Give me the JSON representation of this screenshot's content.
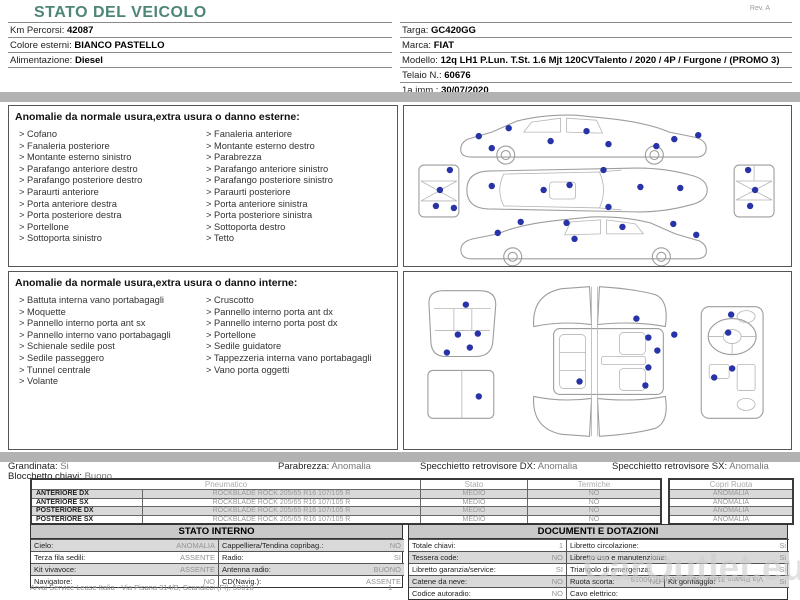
{
  "page": {
    "title": "STATO DEL VEICOLO",
    "rev": "Rev. A"
  },
  "colors": {
    "title": "#4d8577",
    "marker": "#2733a6"
  },
  "vehicle_info": {
    "left": [
      {
        "label": "Km Percorsi:",
        "value": "42087"
      },
      {
        "label": "Colore esterni:",
        "value": "BIANCO PASTELLO"
      },
      {
        "label": "Alimentazione:",
        "value": "Diesel"
      }
    ],
    "right": [
      {
        "label": "Targa:",
        "value": "GC420GG"
      },
      {
        "label": "Marca:",
        "value": "FIAT"
      },
      {
        "label": "Modello:",
        "value": "12q LH1 P.Lun. T.St. 1.6 Mjt 120CVTalento / 2020 / 4P / Furgone / (PROMO 3)"
      },
      {
        "label": "Telaio N.:",
        "value": "60676"
      },
      {
        "label": "1a imm.:",
        "value": "30/07/2020"
      }
    ]
  },
  "exterior_section": {
    "header": "Anomalie da normale usura,extra usura o danno esterne:",
    "col1": [
      "Cofano",
      "Fanaleria posteriore",
      "Montante esterno sinistro",
      "Parafango anteriore destro",
      "Parafango posteriore destro",
      "Paraurti anteriore",
      "Porta anteriore destra",
      "Porta posteriore destra",
      "Portellone",
      "Sottoporta sinistro"
    ],
    "col2": [
      "Fanaleria anteriore",
      "Montante esterno destro",
      "Parabrezza",
      "Parafango anteriore sinistro",
      "Parafango posteriore sinistro",
      "Paraurti posteriore",
      "Porta anteriore sinistra",
      "Porta posteriore sinistra",
      "Sottoporta destro",
      "Tetto"
    ],
    "markers": [
      [
        75,
        30
      ],
      [
        88,
        42
      ],
      [
        105,
        22
      ],
      [
        147,
        35
      ],
      [
        183,
        25
      ],
      [
        205,
        38
      ],
      [
        253,
        40
      ],
      [
        271,
        33
      ],
      [
        295,
        29
      ],
      [
        88,
        80
      ],
      [
        140,
        84
      ],
      [
        166,
        79
      ],
      [
        200,
        64
      ],
      [
        237,
        81
      ],
      [
        277,
        82
      ],
      [
        205,
        101
      ],
      [
        46,
        64
      ],
      [
        36,
        84
      ],
      [
        32,
        100
      ],
      [
        50,
        102
      ],
      [
        345,
        64
      ],
      [
        352,
        84
      ],
      [
        347,
        100
      ],
      [
        94,
        127
      ],
      [
        117,
        116
      ],
      [
        163,
        117
      ],
      [
        171,
        133
      ],
      [
        219,
        121
      ],
      [
        270,
        118
      ],
      [
        293,
        129
      ]
    ]
  },
  "interior_section": {
    "header": "Anomalie da normale usura,extra usura o danno interne:",
    "col1": [
      "Battuta interna vano portabagagli",
      "Moquette",
      "Pannello interno porta ant sx",
      "Pannello interno vano portabagagli",
      "Schienale sedile post",
      "Sedile passeggero",
      "Tunnel centrale",
      "Volante"
    ],
    "col2": [
      "Cruscotto",
      "Pannello interno porta ant dx",
      "Pannello interno porta post dx",
      "Portellone",
      "Sedile guidatore",
      "Tappezzeria interna vano portabagagli",
      "Vano porta oggetti"
    ],
    "markers": [
      [
        62,
        24
      ],
      [
        54,
        54
      ],
      [
        74,
        53
      ],
      [
        66,
        67
      ],
      [
        43,
        72
      ],
      [
        75,
        116
      ],
      [
        233,
        38
      ],
      [
        245,
        57
      ],
      [
        271,
        54
      ],
      [
        254,
        70
      ],
      [
        245,
        87
      ],
      [
        176,
        101
      ],
      [
        242,
        105
      ],
      [
        328,
        34
      ],
      [
        325,
        52
      ],
      [
        329,
        88
      ],
      [
        311,
        97
      ]
    ]
  },
  "condition": {
    "grandinata": {
      "label": "Grandinata:",
      "value": "Si"
    },
    "blocchetto": {
      "label": "Blocchetto chiavi:",
      "value": "Buono"
    },
    "parabrezza": {
      "label": "Parabrezza:",
      "value": "Anomalia"
    },
    "specchietto_dx": {
      "label": "Specchietto retrovisore DX:",
      "value": "Anomalia"
    },
    "specchietto_sx": {
      "label": "Specchietto retrovisore SX:",
      "value": "Anomalia"
    }
  },
  "tyre_table": {
    "header_pneumatico": "Pneumatico",
    "header_stato": "Stato",
    "header_termiche": "Termiche",
    "header_copri": "Copri Ruota",
    "rows": [
      {
        "position": "ANTERIORE DX",
        "tyre": "ROCKBLADE ROCK 205/65 R16 107/105 R",
        "stato": "MEDIO",
        "termiche": "NO",
        "copri": "ANOMALIA"
      },
      {
        "position": "ANTERIORE SX",
        "tyre": "ROCKBLADE ROCK 205/65 R16 107/105 R",
        "stato": "MEDIO",
        "termiche": "NO",
        "copri": "ANOMALIA"
      },
      {
        "position": "POSTERIORE DX",
        "tyre": "ROCKBLADE ROCK 205/65 R16 107/105 R",
        "stato": "MEDIO",
        "termiche": "NO",
        "copri": "ANOMALIA"
      },
      {
        "position": "POSTERIORE SX",
        "tyre": "ROCKBLADE ROCK 205/65 R16 107/105 R",
        "stato": "MEDIO",
        "termiche": "NO",
        "copri": "ANOMALIA"
      }
    ]
  },
  "stato_interno": {
    "title": "STATO INTERNO",
    "rows": [
      {
        "l1": "Cielo:",
        "v1": "ANOMALIA",
        "l2": "Cappelliera/Tendina copribag.:",
        "v2": "NO"
      },
      {
        "l1": "Terza fila sedili:",
        "v1": "ASSENTE",
        "l2": "Radio:",
        "v2": "SI"
      },
      {
        "l1": "Kit vivavoce:",
        "v1": "ASSENTE",
        "l2": "Antenna radio:",
        "v2": "BUONO"
      },
      {
        "l1": "Navigatore:",
        "v1": "NO",
        "l2": "CD(Navig.):",
        "v2": "ASSENTE"
      }
    ]
  },
  "documenti": {
    "title": "DOCUMENTI E DOTAZIONI",
    "rows": [
      {
        "l1": "Totale chiavi:",
        "v1": "1",
        "l2": "Libretto circolazione:",
        "v2": "Si"
      },
      {
        "l1": "Tessera code:",
        "v1": "NO",
        "l2": "Libretto uso e manutenzione:",
        "v2": "Si"
      },
      {
        "l1": "Libretto garanzia/service:",
        "v1": "SI",
        "l2": "Triangolo di emergenza:",
        "v2": "Si"
      },
      {
        "l1": "Catene da neve:",
        "v1": "NO",
        "l2": "Ruota scorta:",
        "v2": "NO",
        "l3": "Kit gonfiaggio:",
        "v3": "Si"
      },
      {
        "l1": "Codice autoradio:",
        "v1": "NO",
        "l2": "Cavo elettrico:",
        "v2": ""
      }
    ]
  },
  "footer": {
    "company": "Arval Service Lease Italia - Via Pisana 314/B, Scandicci (FI), 50018",
    "page_number": "1",
    "watermark": "CarOutlet.eu",
    "mirrored_text": "Via Pisana 314/B, Scandicci (FI), 50018"
  }
}
